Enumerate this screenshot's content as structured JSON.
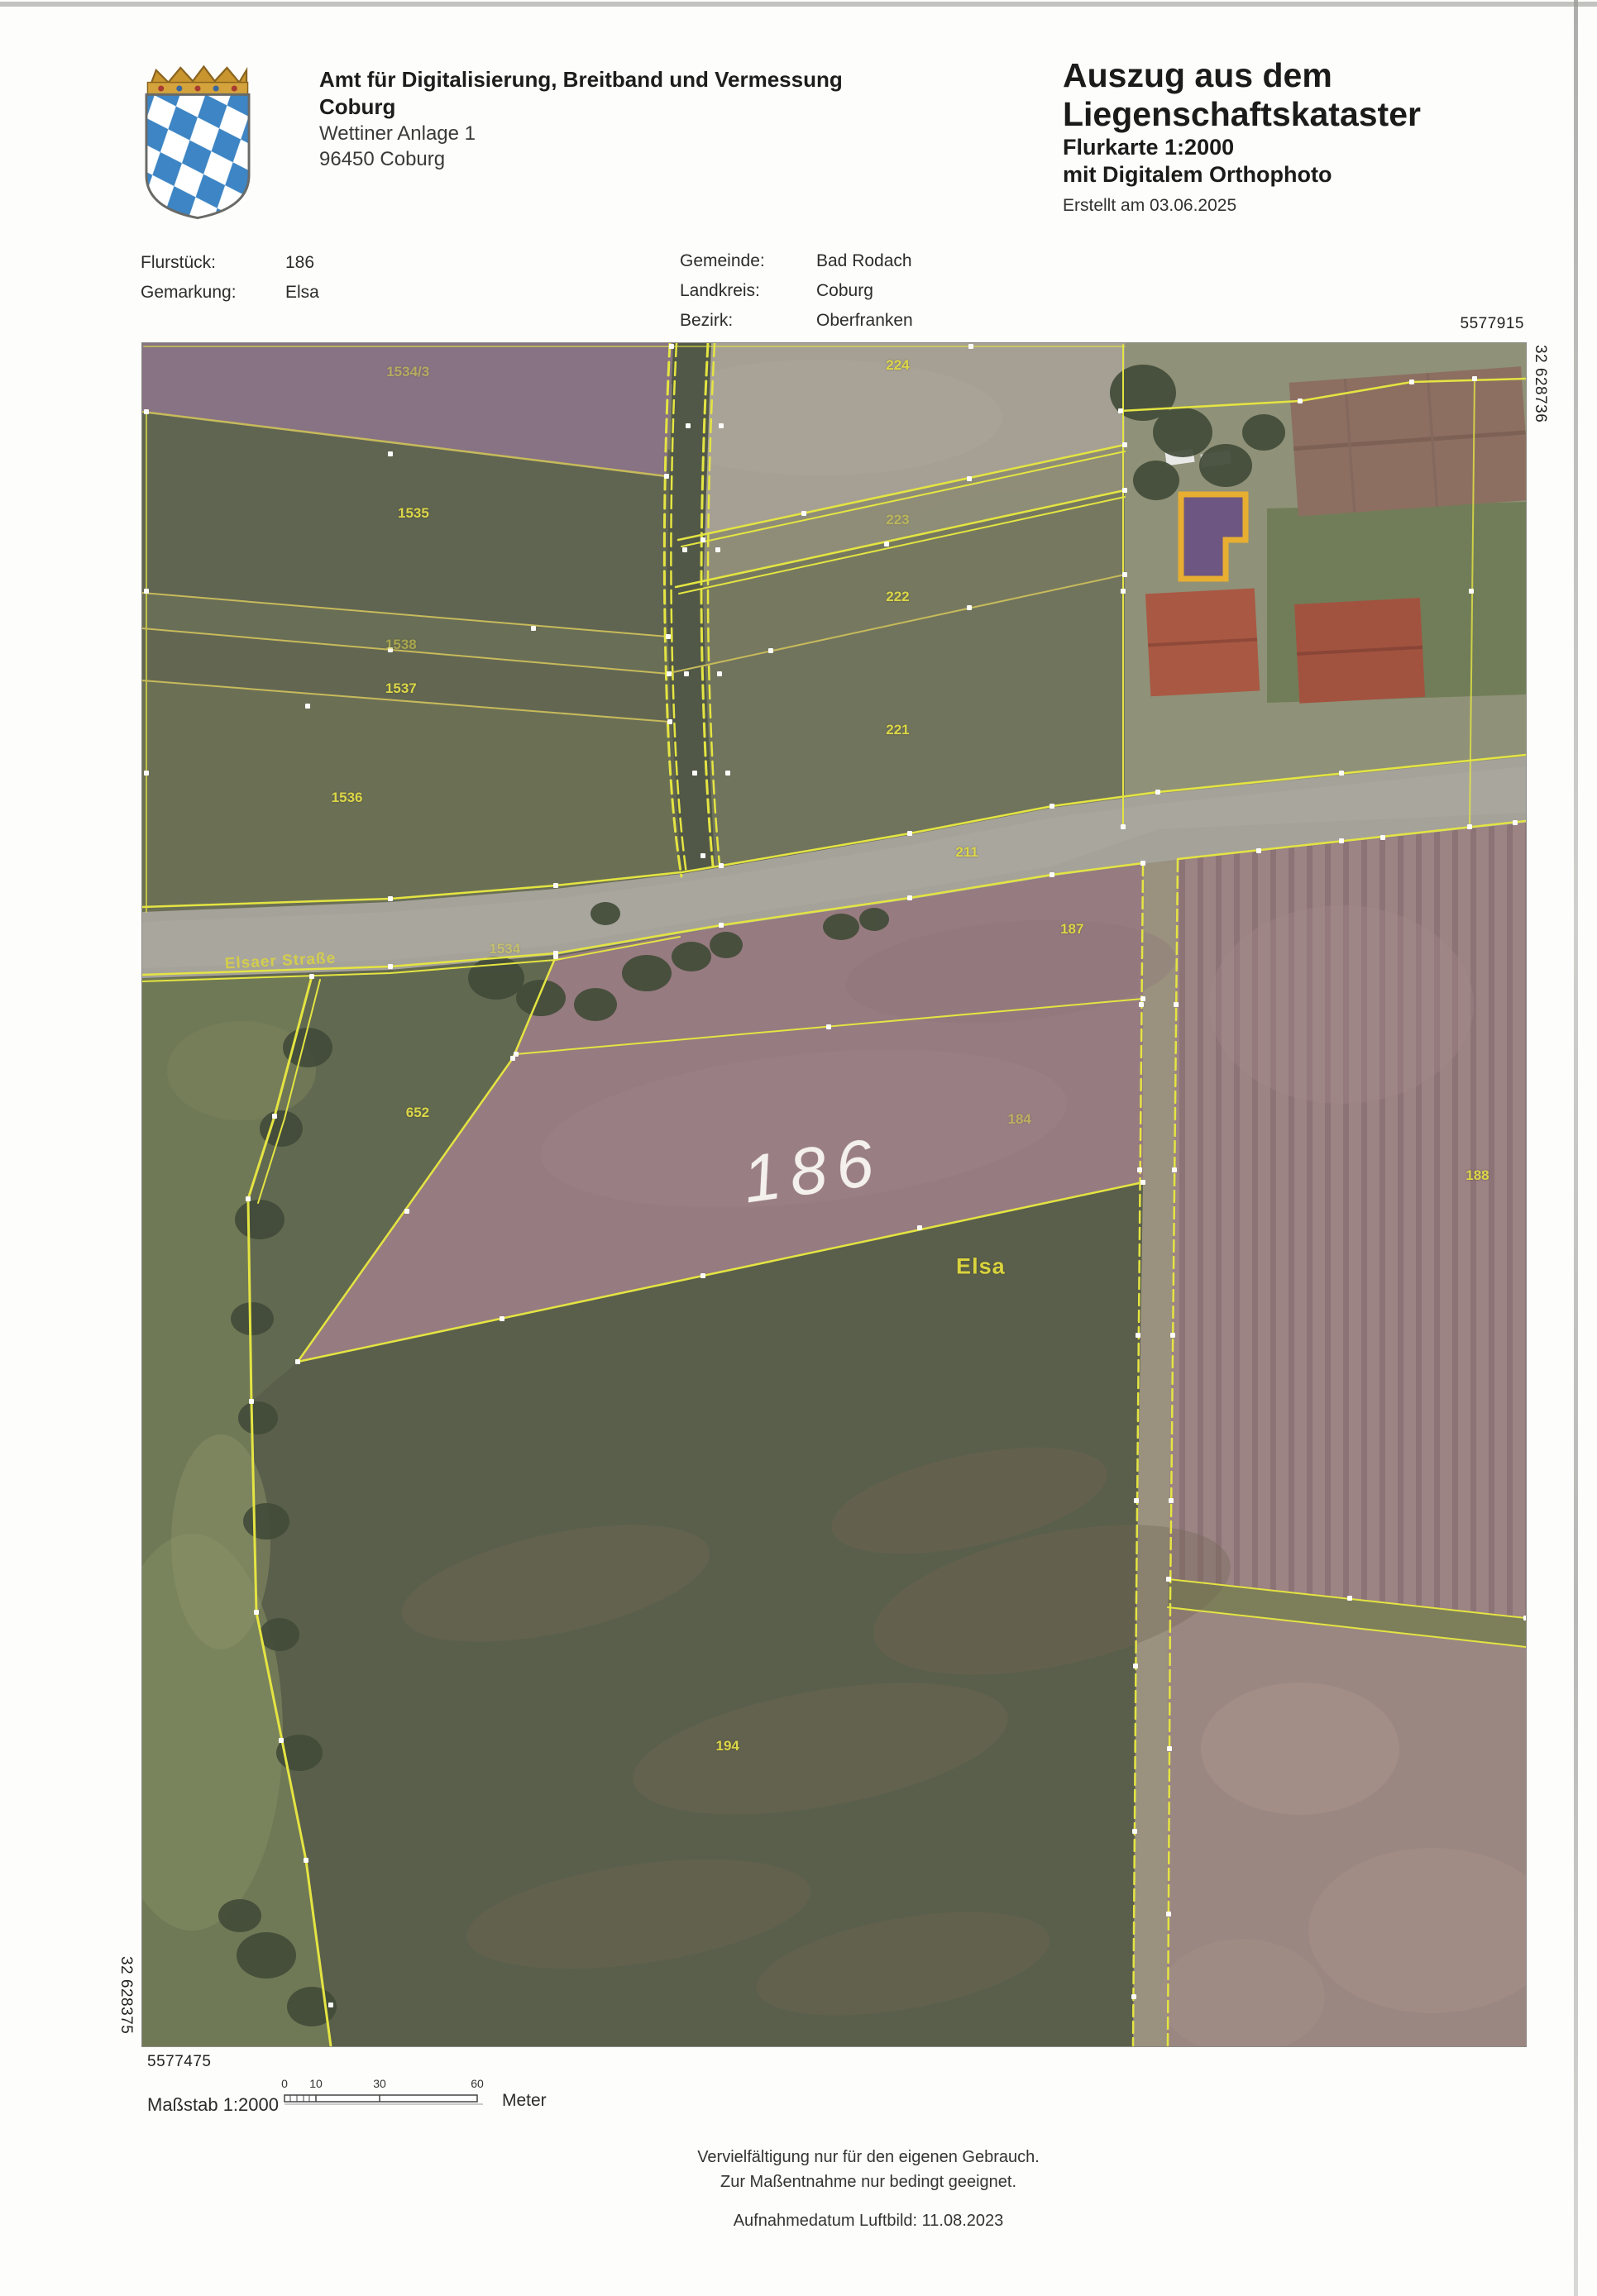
{
  "header": {
    "agency_line1": "Amt für Digitalisierung, Breitband und Vermessung",
    "agency_line2": "Coburg",
    "agency_street": "Wettiner Anlage 1",
    "agency_city": "96450 Coburg"
  },
  "title_block": {
    "line1": "Auszug aus dem",
    "line2": "Liegenschaftskataster",
    "line3": "Flurkarte 1:2000",
    "line4": "mit Digitalem Orthophoto",
    "created": "Erstellt am 03.06.2025"
  },
  "metadata": {
    "flurstueck_label": "Flurstück:",
    "flurstueck_value": "186",
    "gemarkung_label": "Gemarkung:",
    "gemarkung_value": "Elsa",
    "gemeinde_label": "Gemeinde:",
    "gemeinde_value": "Bad Rodach",
    "landkreis_label": "Landkreis:",
    "landkreis_value": "Coburg",
    "bezirk_label": "Bezirk:",
    "bezirk_value": "Oberfranken"
  },
  "coordinates": {
    "top_right": "5577915",
    "right_vertical": "32 628736",
    "left_vertical": "32 628375",
    "bottom_left": "5577475"
  },
  "scale": {
    "label": "Maßstab 1:2000",
    "ticks": [
      "0",
      "10",
      "30",
      "60"
    ],
    "unit": "Meter"
  },
  "footer": {
    "line1": "Vervielfältigung nur für den eigenen Gebrauch.",
    "line2": "Zur Maßentnahme nur bedingt geeignet.",
    "line3": "Aufnahmedatum Luftbild: 11.08.2023"
  },
  "map": {
    "labels": [
      {
        "text": "1534/3",
        "x": 19.2,
        "y": 1.7,
        "type": "parcel",
        "dim": true
      },
      {
        "text": "1535",
        "x": 19.6,
        "y": 10.0,
        "type": "parcel"
      },
      {
        "text": "1538",
        "x": 18.7,
        "y": 17.7,
        "type": "parcel",
        "dim": true
      },
      {
        "text": "1537",
        "x": 18.7,
        "y": 20.3,
        "type": "parcel"
      },
      {
        "text": "1536",
        "x": 14.8,
        "y": 26.7,
        "type": "parcel"
      },
      {
        "text": "224",
        "x": 54.6,
        "y": 1.3,
        "type": "parcel"
      },
      {
        "text": "223",
        "x": 54.6,
        "y": 10.4,
        "type": "parcel",
        "dim": true
      },
      {
        "text": "222",
        "x": 54.6,
        "y": 14.9,
        "type": "parcel"
      },
      {
        "text": "221",
        "x": 54.6,
        "y": 22.7,
        "type": "parcel"
      },
      {
        "text": "211",
        "x": 59.6,
        "y": 29.9,
        "type": "parcel"
      },
      {
        "text": "187",
        "x": 67.2,
        "y": 34.4,
        "type": "parcel"
      },
      {
        "text": "1534",
        "x": 26.2,
        "y": 35.6,
        "type": "parcel",
        "dim": true
      },
      {
        "text": "Elsaer Straße",
        "x": 10.0,
        "y": 36.3,
        "type": "street",
        "rot": -3
      },
      {
        "text": "652",
        "x": 19.9,
        "y": 45.2,
        "type": "parcel"
      },
      {
        "text": "186",
        "x": 48.5,
        "y": 48.6,
        "type": "highlight",
        "rot": -8
      },
      {
        "text": "184",
        "x": 63.4,
        "y": 45.6,
        "type": "parcel",
        "dim": true
      },
      {
        "text": "Elsa",
        "x": 60.6,
        "y": 54.2,
        "type": "name"
      },
      {
        "text": "188",
        "x": 96.5,
        "y": 48.9,
        "type": "parcel"
      },
      {
        "text": "194",
        "x": 42.3,
        "y": 82.4,
        "type": "parcel"
      }
    ]
  },
  "colors": {
    "boundary_yellow": "#e7e73e",
    "boundary_dull": "#c9bb58",
    "vertex_white": "#ffffff",
    "parcel_label": "#dcd648",
    "name_label": "#d9d33e",
    "highlight_label": "#f4f1ec"
  }
}
